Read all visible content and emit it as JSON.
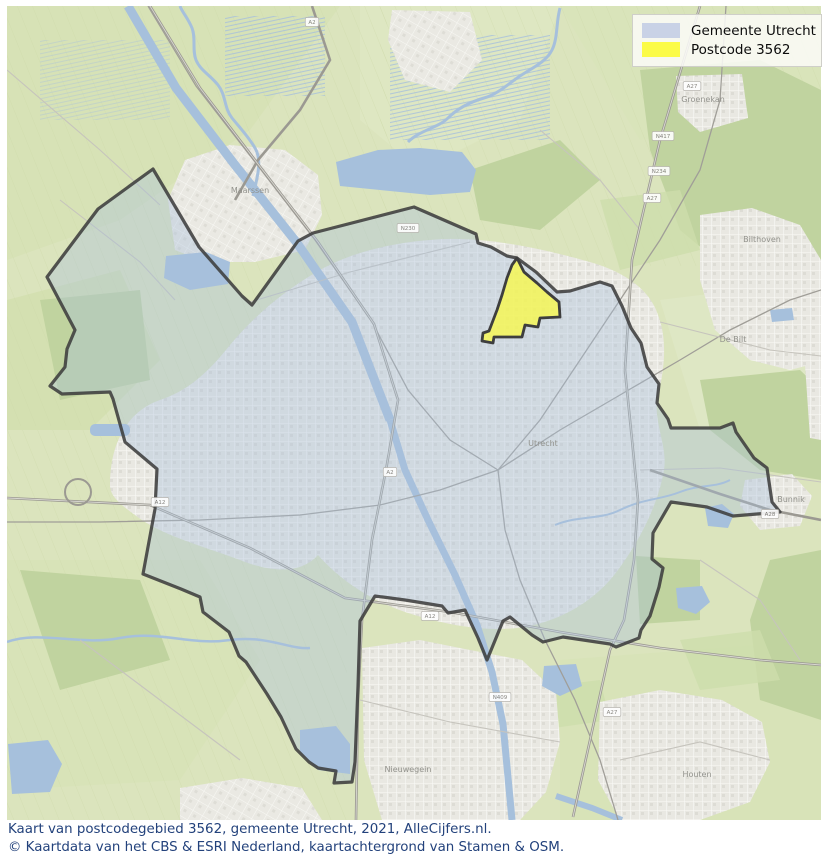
{
  "legend": {
    "items": [
      {
        "label": "Gemeente Utrecht",
        "color": "#c9d2e6"
      },
      {
        "label": "Postcode 3562",
        "color": "#fbfb47"
      }
    ]
  },
  "caption": {
    "line1": "Kaart van postcodegebied 3562, gemeente Utrecht, 2021, AlleCijfers.nl.",
    "line2": "© Kaartdata van het CBS & ESRI Nederland, kaartachtergrond van Stamen & OSM."
  },
  "map": {
    "colors": {
      "countryside": "#dbe4bd",
      "forest": "#c0d39f",
      "urban": "#eae9e3",
      "water": "#a6c0dc",
      "municipality_fill": "#a9c0dc",
      "municipality_outline": "#3e3e3e",
      "postcode_fill": "#f8f84e",
      "caption_text": "#23427c"
    },
    "municipality_points": "153,169 199,247 242,296 252,305 298,241 313,233 414,207 476,234 478,243 491,247 507,256 517,258 536,272 557,292 570,291 600,282 612,286 622,306 631,328 641,343 647,367 659,384 657,403 668,419 671,428 720,428 733,423 736,432 754,458 767,468 772,502 780,512 757,514 733,516 707,507 671,502 653,533 652,559 663,568 659,587 650,616 641,630 639,638 616,647 610,644 563,637 543,642 532,635 510,617 503,621 487,660 478,638 465,610 448,613 442,606 405,600 375,596 360,621 358,686 355,762 352,782 334,783 336,771 318,768 309,762 296,749 281,717 267,694 246,662 239,656 229,632 203,612 200,597 181,589 143,574 155,509 157,469 125,442 113,399 110,392 62,394 50,386 65,367 67,349 75,330 47,277 98,209",
    "postcode_points": "517,258 524,272 537,283 547,292 559,302 560,317 540,318 538,327 525,325 522,337 503,337 494,337 493,343 482,341 483,333 489,331 497,310 502,295 507,278 512,265",
    "place_labels": [
      {
        "name": "Maarssen",
        "x": 250,
        "y": 193
      },
      {
        "name": "Utrecht",
        "x": 543,
        "y": 446
      },
      {
        "name": "Groenekan",
        "x": 703,
        "y": 102
      },
      {
        "name": "Bilthoven",
        "x": 762,
        "y": 242
      },
      {
        "name": "De Bilt",
        "x": 733,
        "y": 342
      },
      {
        "name": "Bunnik",
        "x": 791,
        "y": 502
      },
      {
        "name": "Houten",
        "x": 697,
        "y": 777
      },
      {
        "name": "Nieuwegein",
        "x": 408,
        "y": 772
      }
    ],
    "road_shields": [
      {
        "label": "A2",
        "x": 312,
        "y": 22
      },
      {
        "label": "A27",
        "x": 692,
        "y": 86
      },
      {
        "label": "N417",
        "x": 663,
        "y": 136
      },
      {
        "label": "N234",
        "x": 659,
        "y": 171
      },
      {
        "label": "A27",
        "x": 652,
        "y": 198
      },
      {
        "label": "N230",
        "x": 408,
        "y": 228
      },
      {
        "label": "A2",
        "x": 390,
        "y": 472
      },
      {
        "label": "A12",
        "x": 160,
        "y": 502
      },
      {
        "label": "A12",
        "x": 430,
        "y": 616
      },
      {
        "label": "A28",
        "x": 770,
        "y": 514
      },
      {
        "label": "A27",
        "x": 612,
        "y": 712
      },
      {
        "label": "N409",
        "x": 500,
        "y": 697
      }
    ]
  }
}
